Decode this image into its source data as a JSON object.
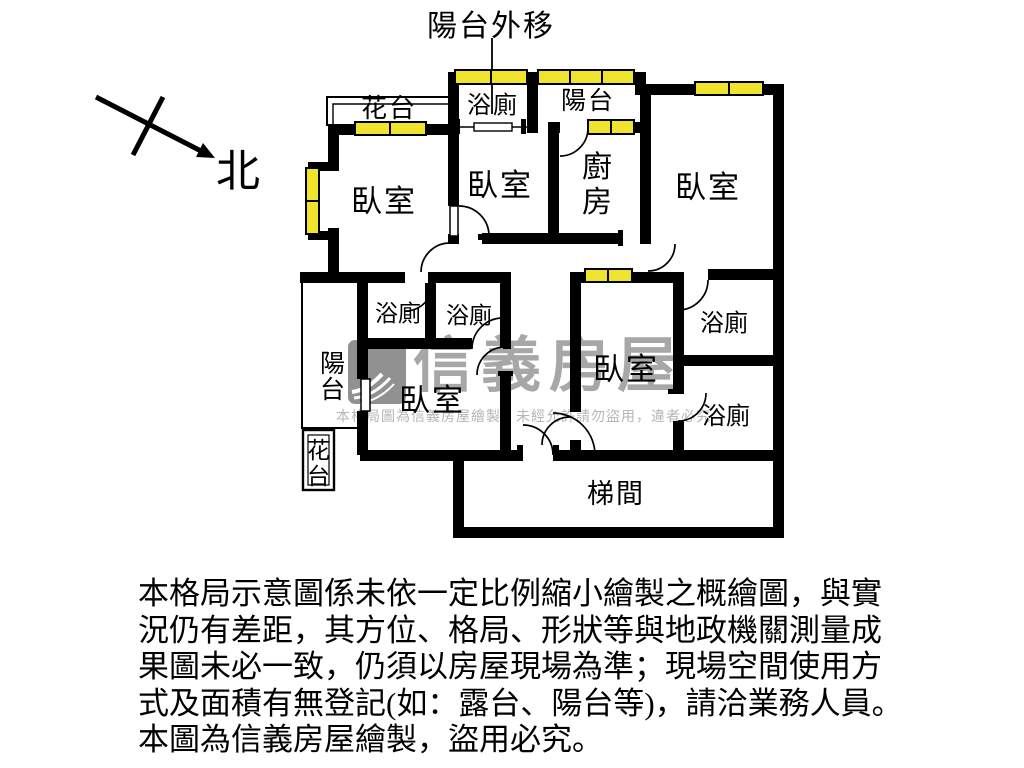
{
  "plan": {
    "annotation_balcony_moved": "陽台外移",
    "north_label": "北",
    "rooms": {
      "flower_bed_top": "花台",
      "bath_top": "浴廁",
      "balcony_top": "陽台",
      "bedroom_top_left": "臥室",
      "bedroom_top_middle": "臥室",
      "kitchen_char1": "廚",
      "kitchen_char2": "房",
      "bedroom_top_right": "臥室",
      "bath_mid_left": "浴廁",
      "bath_mid_right": "浴廁",
      "balcony_left_char1": "陽",
      "balcony_left_char2": "台",
      "bedroom_bottom_left": "臥室",
      "bedroom_bottom_middle": "臥室",
      "bath_right_upper": "浴廁",
      "bath_right_lower": "浴廁",
      "flower_bed_bottom_char1": "花",
      "flower_bed_bottom_char2": "台",
      "stairwell": "梯間"
    },
    "colors": {
      "wall": "#000000",
      "window_fill": "#efe32d"
    }
  },
  "watermark": {
    "brand": "信義房屋",
    "notice": "本格局圖為信義房屋繪製，未經允許請勿盜用，違者必究",
    "brand_color": "#a7a7a7"
  },
  "disclaimer": {
    "line1": "本格局示意圖係未依一定比例縮小繪製之概繪圖，與實",
    "line2": "況仍有差距，其方位、格局、形狀等與地政機關測量成",
    "line3": "果圖未必一致，仍須以房屋現場為準；現場空間使用方",
    "line4": "式及面積有無登記(如：露台、陽台等)，請洽業務人員。",
    "line5": "本圖為信義房屋繪製，盜用必究。"
  }
}
